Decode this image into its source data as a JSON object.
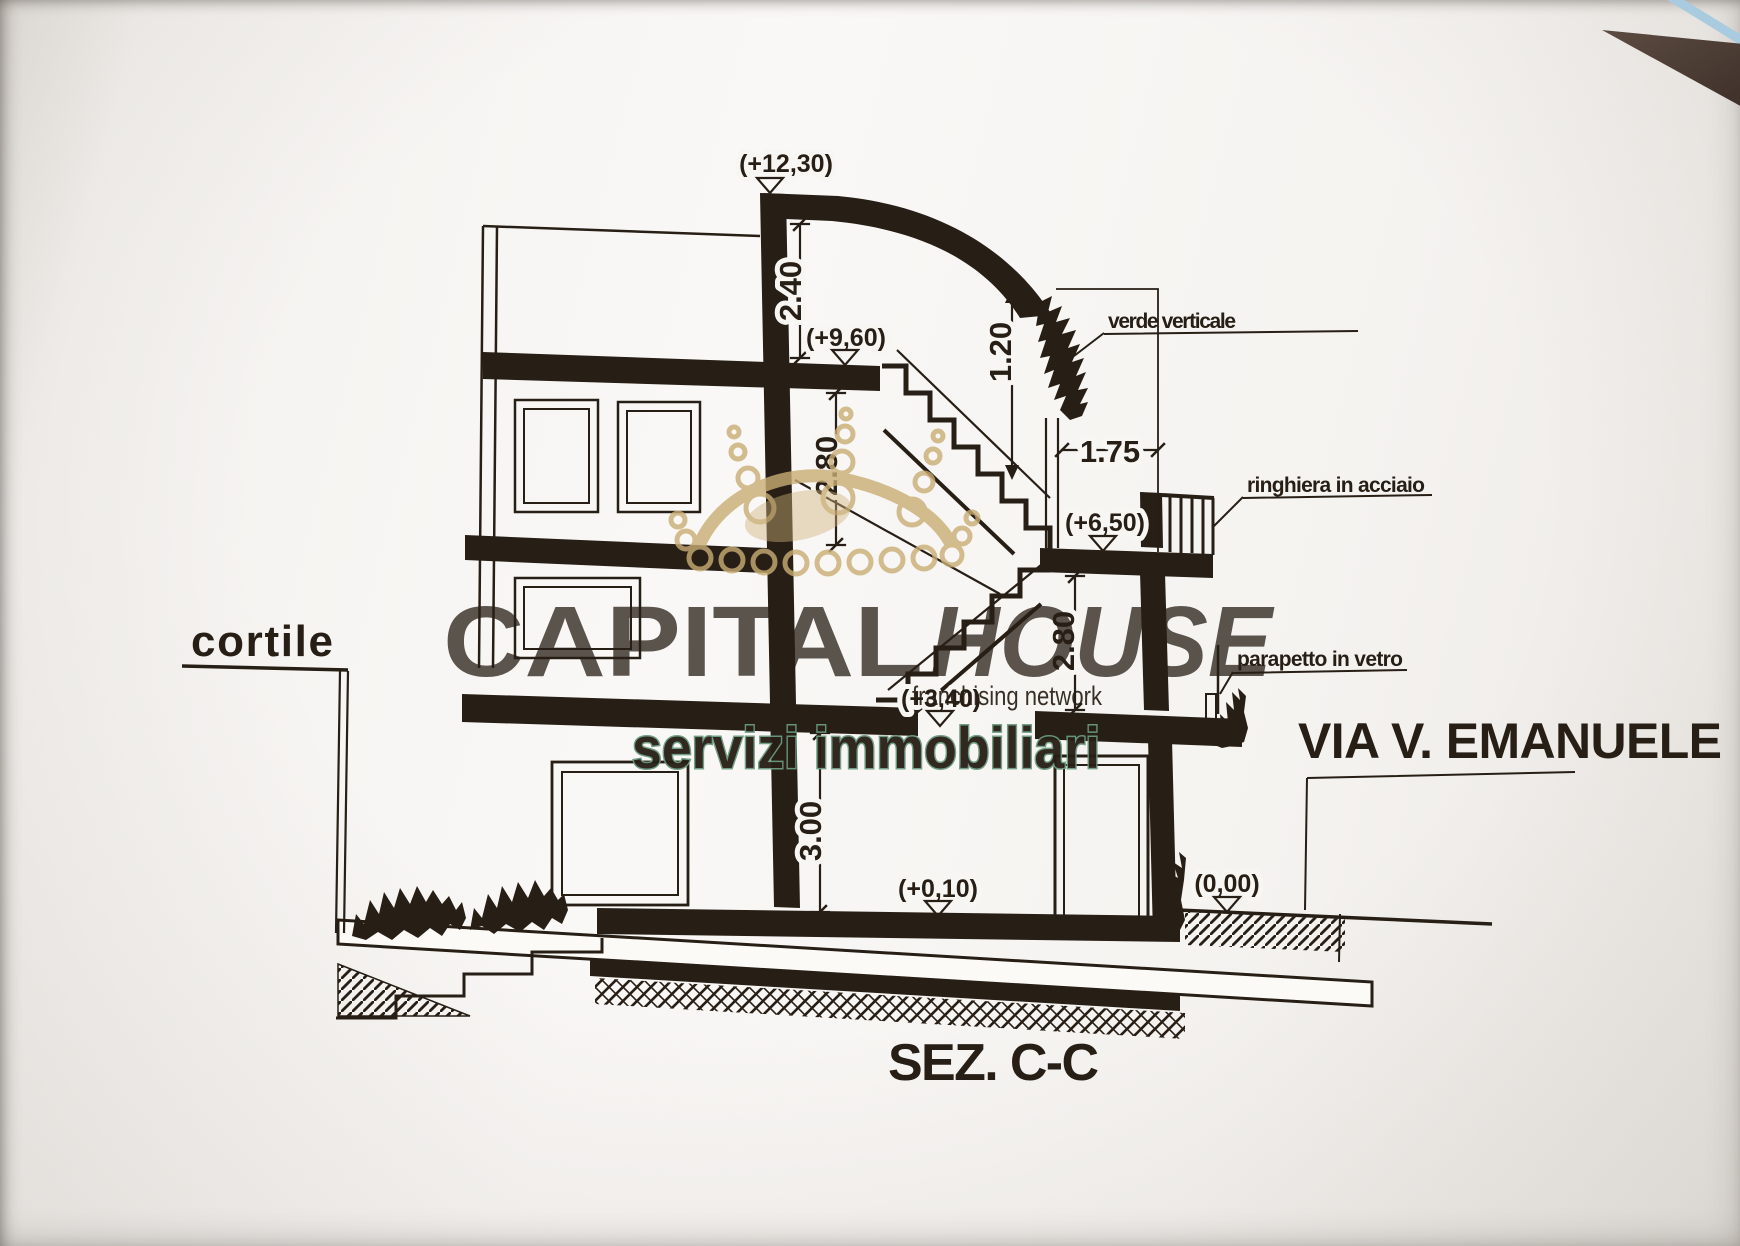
{
  "drawing": {
    "section_title": "SEZ. C-C",
    "street_label": "VIA V. EMANUELE",
    "courtyard_label": "cortile",
    "elevation_markers": [
      {
        "label": "(+12,30)"
      },
      {
        "label": "(+9,60)"
      },
      {
        "label": "(+6,50)"
      },
      {
        "label": "(+3,40)"
      },
      {
        "label": "(+0,10)"
      },
      {
        "label": "(0,00)"
      }
    ],
    "dimensions": [
      {
        "label": "2.40"
      },
      {
        "label": "1.20"
      },
      {
        "label": "2.80"
      },
      {
        "label": "1.75"
      },
      {
        "label": "2.80"
      },
      {
        "label": "3.00"
      }
    ],
    "annotations": [
      {
        "label": "verde verticale"
      },
      {
        "label": "ringhiera in acciaio"
      },
      {
        "label": "parapetto in vetro"
      }
    ]
  },
  "watermark": {
    "brand_part1": "CAPITAL",
    "brand_part2": "HOUSE",
    "tagline": "franchising network",
    "subtitle": "servizi immobiliari",
    "colors": {
      "brand": "#a7c4b0",
      "tagline": "#a3c8b2",
      "subtitle_stroke": "#6a9a80",
      "crown": "#c9ad74"
    }
  },
  "colors": {
    "ink": "#271e15",
    "paper": "#f7f5f2",
    "corner_wedge": "#4a3b33",
    "corner_stripe": "#a9cbdf"
  }
}
